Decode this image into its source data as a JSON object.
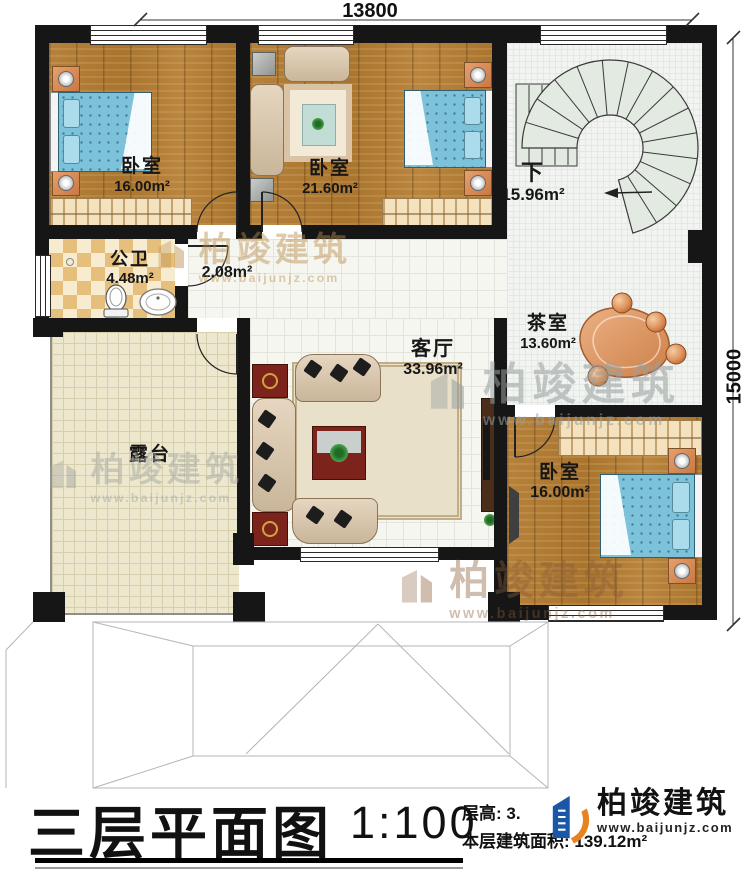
{
  "dimensions": {
    "top": "13800",
    "right": "15000"
  },
  "rooms": {
    "bedroom1": {
      "name": "卧室",
      "area": "16.00m²"
    },
    "bedroom2": {
      "name": "卧室",
      "area": "21.60m²"
    },
    "stairs": {
      "name": "下",
      "area": "15.96m²"
    },
    "bathroom": {
      "name": "公卫",
      "area": "4.48m²"
    },
    "hall": {
      "area": "2.08m²"
    },
    "living": {
      "name": "客厅",
      "area": "33.96m²"
    },
    "tea": {
      "name": "茶室",
      "area": "13.60m²"
    },
    "bedroom3": {
      "name": "卧室",
      "area": "16.00m²"
    },
    "terrace": {
      "name": "露台"
    }
  },
  "titleblock": {
    "title": "三层平面图",
    "scale": "1:100",
    "floor_height": "层高: 3.",
    "area_line": "本层建筑面积: 139.12m²"
  },
  "logo": {
    "name": "柏竣建筑",
    "url": "www.baijunjz.com"
  },
  "watermark": {
    "name": "柏竣建筑",
    "url": "www.baijunjz.com"
  }
}
